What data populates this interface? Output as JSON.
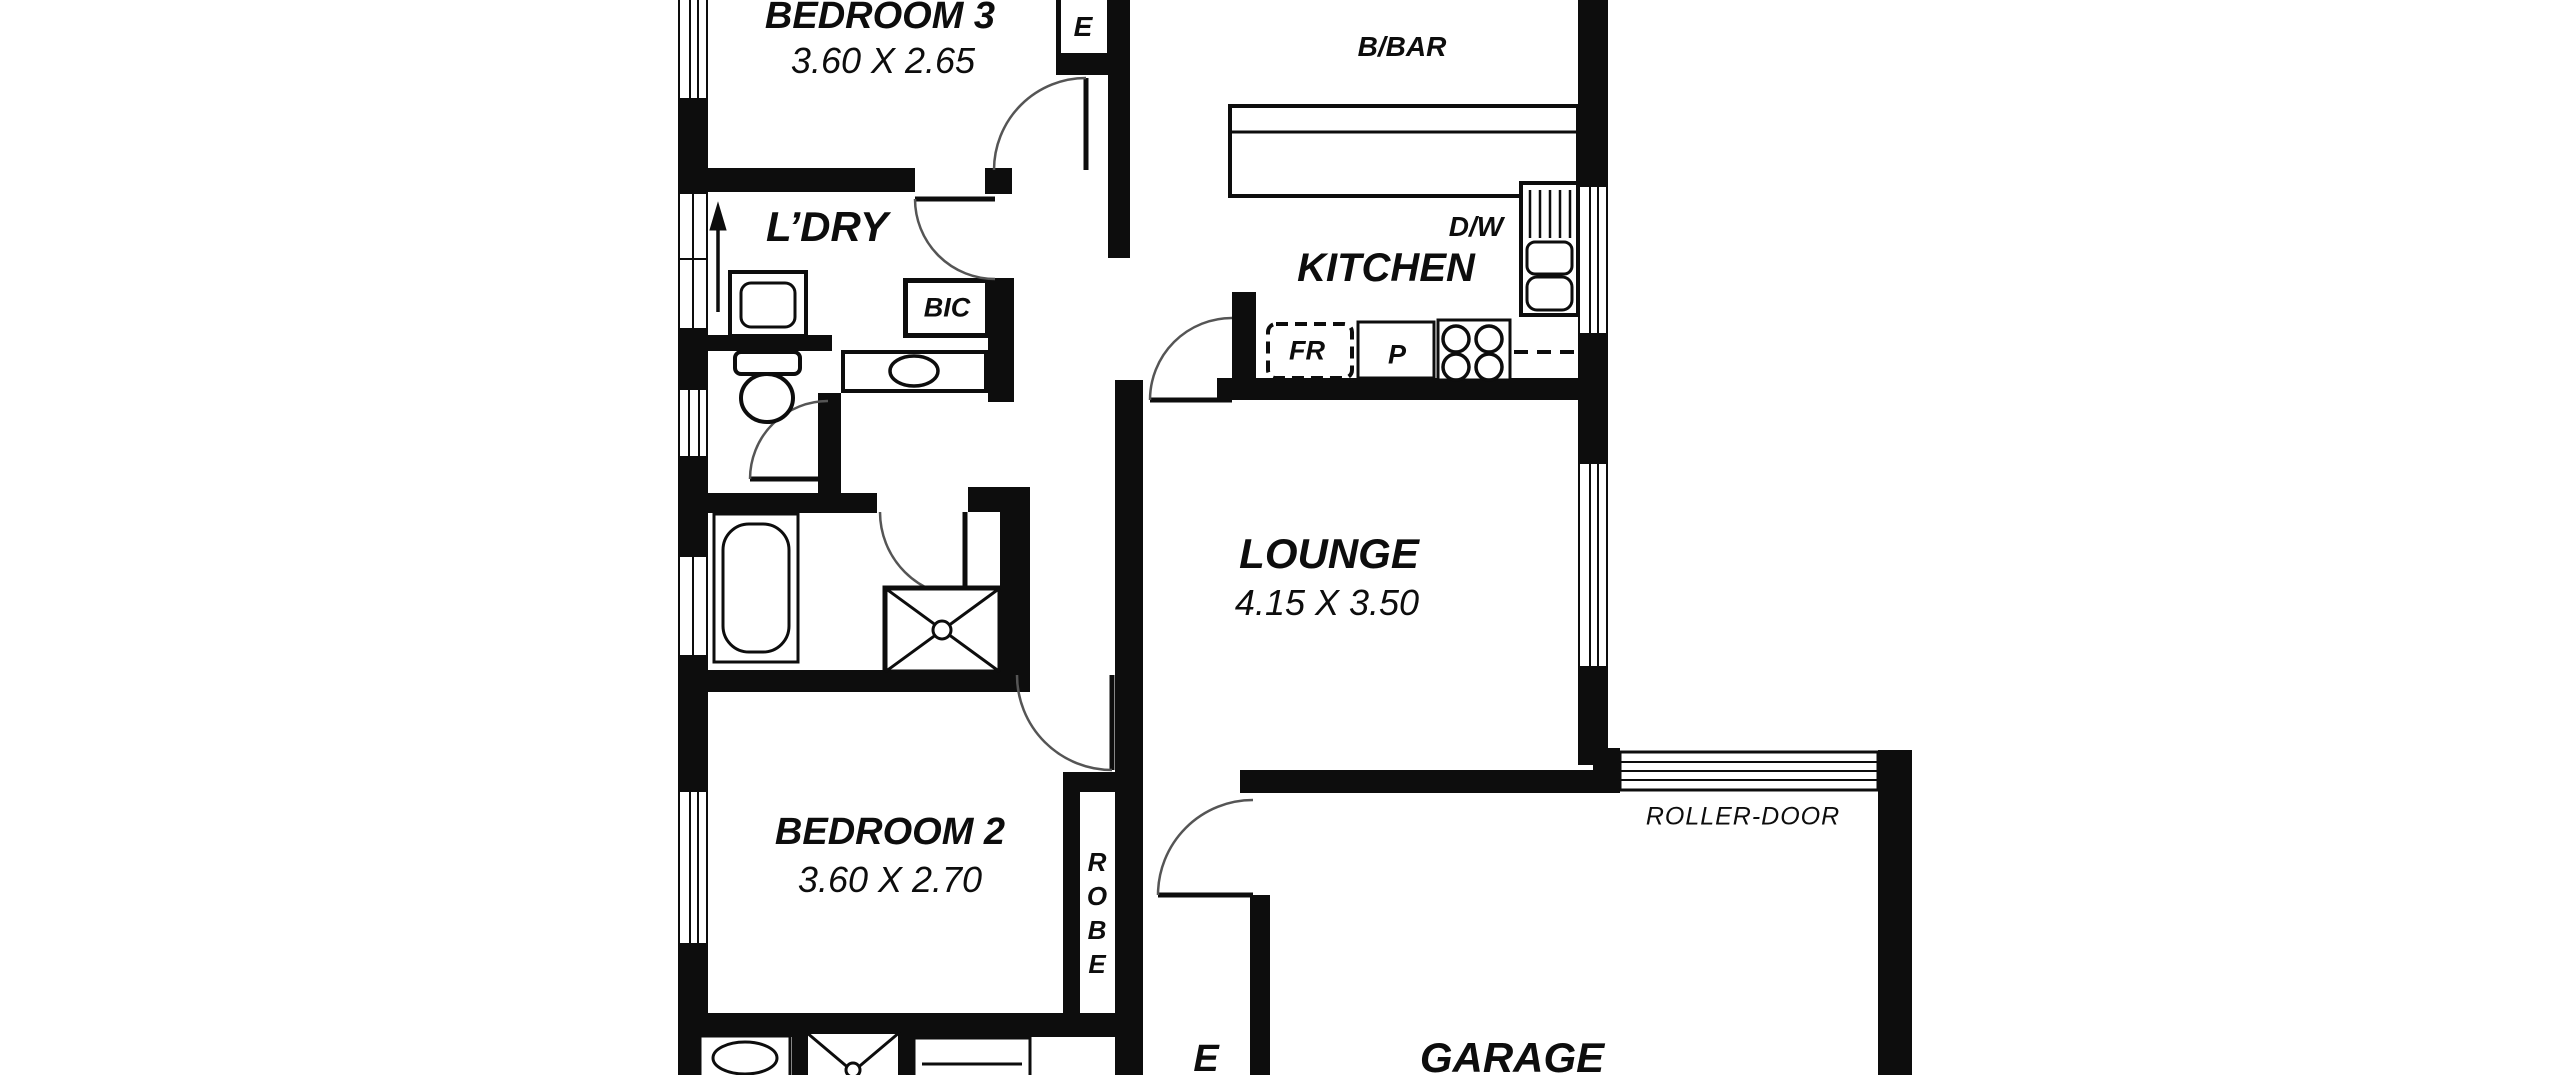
{
  "plan": {
    "type": "residential floor plan",
    "colors": {
      "background": "#ffffff",
      "walls": "#0d0d0d",
      "arc": "#555555"
    },
    "rooms": {
      "bedroom3": {
        "name": "BEDROOM 3",
        "dims": "3.60 X 2.65"
      },
      "laundry": {
        "name": "L’DRY"
      },
      "kitchen": {
        "name": "KITCHEN"
      },
      "lounge": {
        "name": "LOUNGE",
        "dims": "4.15 X 3.50"
      },
      "bedroom2": {
        "name": "BEDROOM 2",
        "dims": "3.60 X 2.70"
      },
      "garage": {
        "name": "GARAGE"
      },
      "entry_partial": {
        "name": "E"
      }
    },
    "fixtures": {
      "bic": "BIC",
      "breakfast_bar": "B/BAR",
      "dishwasher": "D/W",
      "fridge": "FR",
      "pantry": "P",
      "roller_door": "ROLLER-DOOR",
      "robe_bedroom2": "ROBE",
      "robe_bedroom3_partial": "E"
    }
  }
}
